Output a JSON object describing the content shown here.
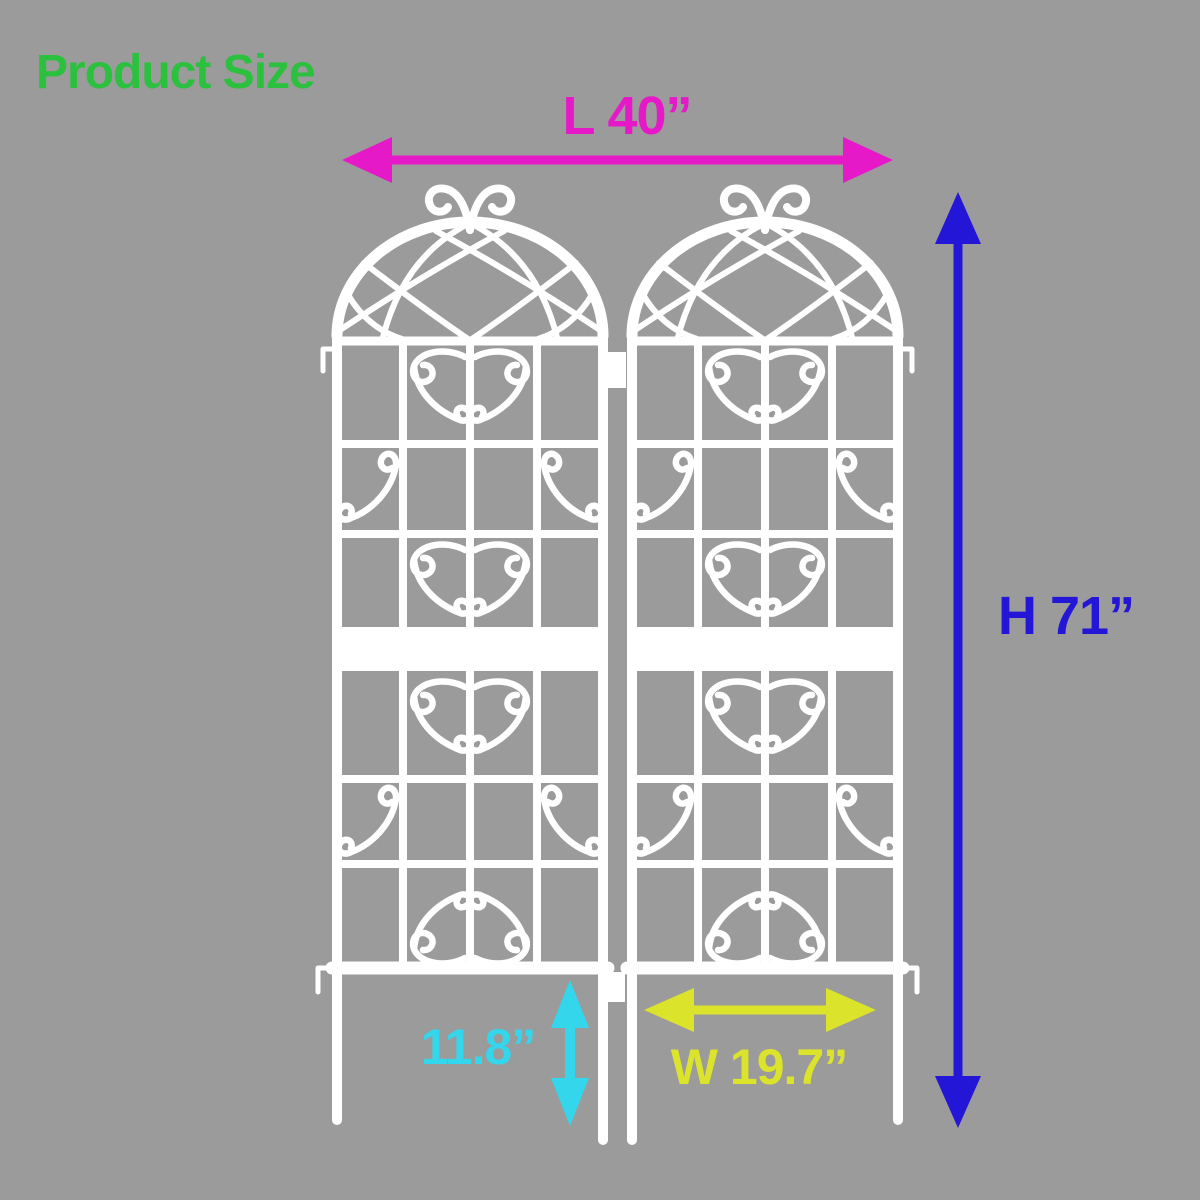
{
  "canvas": {
    "background_color": "#9b9b9b",
    "trellis_color": "#ffffff"
  },
  "title": {
    "text": "Product Size",
    "color": "#2bc13e"
  },
  "dimensions": {
    "length": {
      "label": "L 40”",
      "color": "#e619c8"
    },
    "height": {
      "label": "H 71”",
      "color": "#2316d6"
    },
    "stake": {
      "label": "11.8”",
      "color": "#33d6ea"
    },
    "width": {
      "label": "W 19.7”",
      "color": "#dce32b"
    }
  }
}
